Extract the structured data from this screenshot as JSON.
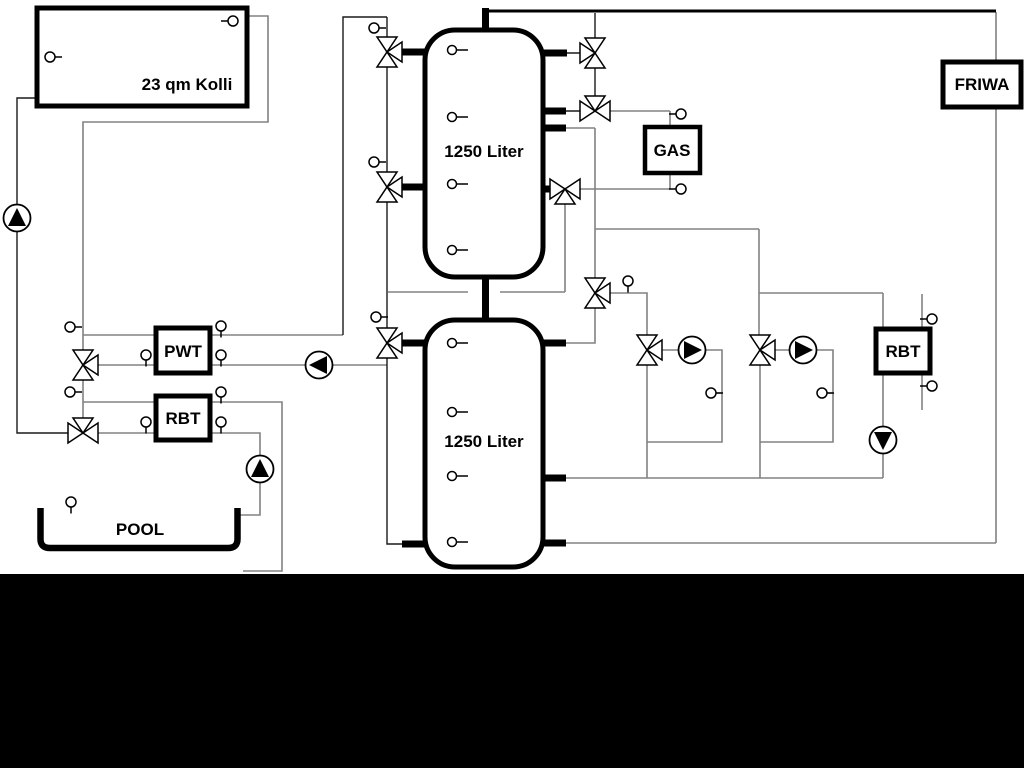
{
  "diagram": {
    "collector": {
      "label": "23 qm Kolli"
    },
    "buffer_tank_top": {
      "label": "1250 Liter"
    },
    "buffer_tank_bottom": {
      "label": "1250 Liter"
    },
    "gas_boiler": {
      "label": "GAS"
    },
    "friwa": {
      "label": "FRIWA"
    },
    "pwt": {
      "label": "PWT"
    },
    "rbt_pool": {
      "label": "RBT"
    },
    "rbt_heating": {
      "label": "RBT"
    },
    "pool": {
      "label": "POOL"
    }
  },
  "colors": {
    "background": "#ffffff",
    "letterbox": "#000000",
    "pipe_gray": "#828282",
    "pipe_black": "#1a1a1a",
    "symbol_fill": "#ffffff"
  }
}
